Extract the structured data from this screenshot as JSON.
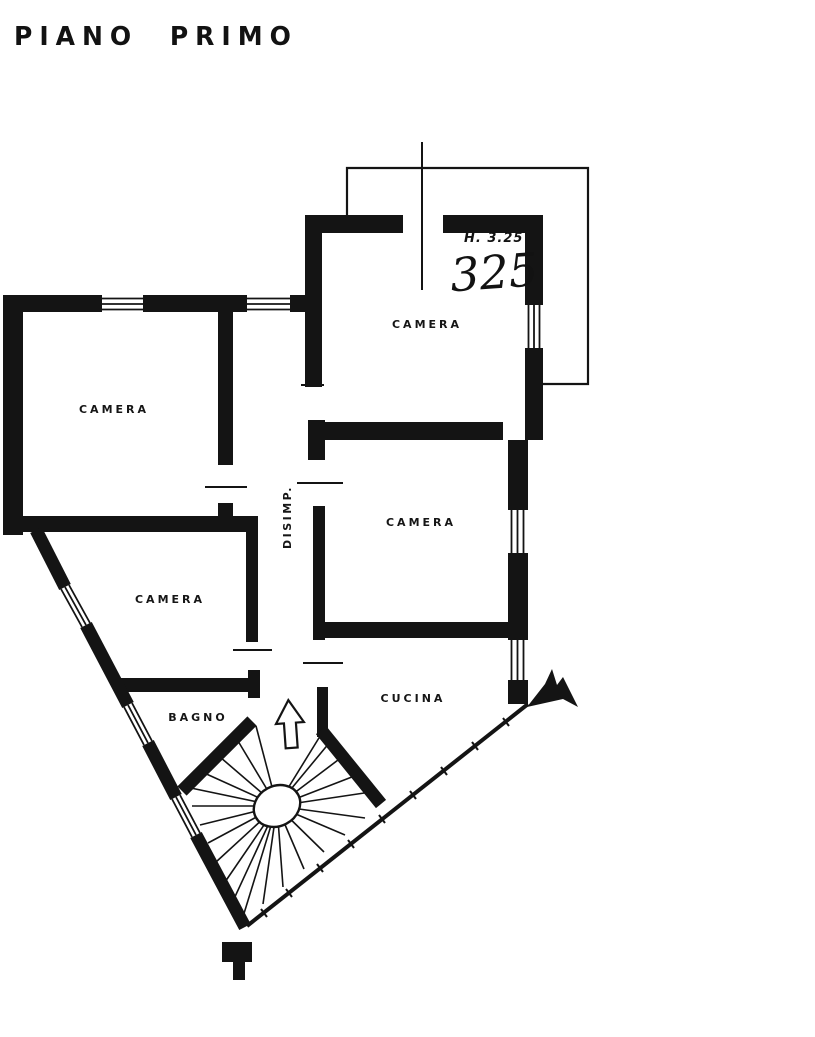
{
  "page": {
    "title": "PIANO PRIMO",
    "paper_color": "#ffffff",
    "ink_color": "#141414"
  },
  "annotations": {
    "ceiling_height_label": "H. 3.25",
    "ceiling_height_handwritten": "325"
  },
  "rooms": [
    {
      "name": "camera-top",
      "label": "CAMERA"
    },
    {
      "name": "camera-left",
      "label": "CAMERA"
    },
    {
      "name": "camera-right",
      "label": "CAMERA"
    },
    {
      "name": "camera-lower-left",
      "label": "CAMERA"
    },
    {
      "name": "cucina",
      "label": "CUCINA"
    },
    {
      "name": "bagno",
      "label": "BAGNO"
    },
    {
      "name": "disimpegno",
      "label": "DISIMP."
    }
  ],
  "symbols": [
    {
      "name": "stair-direction-arrow",
      "meaning": "up"
    },
    {
      "name": "spiral-staircase",
      "meaning": "winding stair with central newel"
    }
  ]
}
